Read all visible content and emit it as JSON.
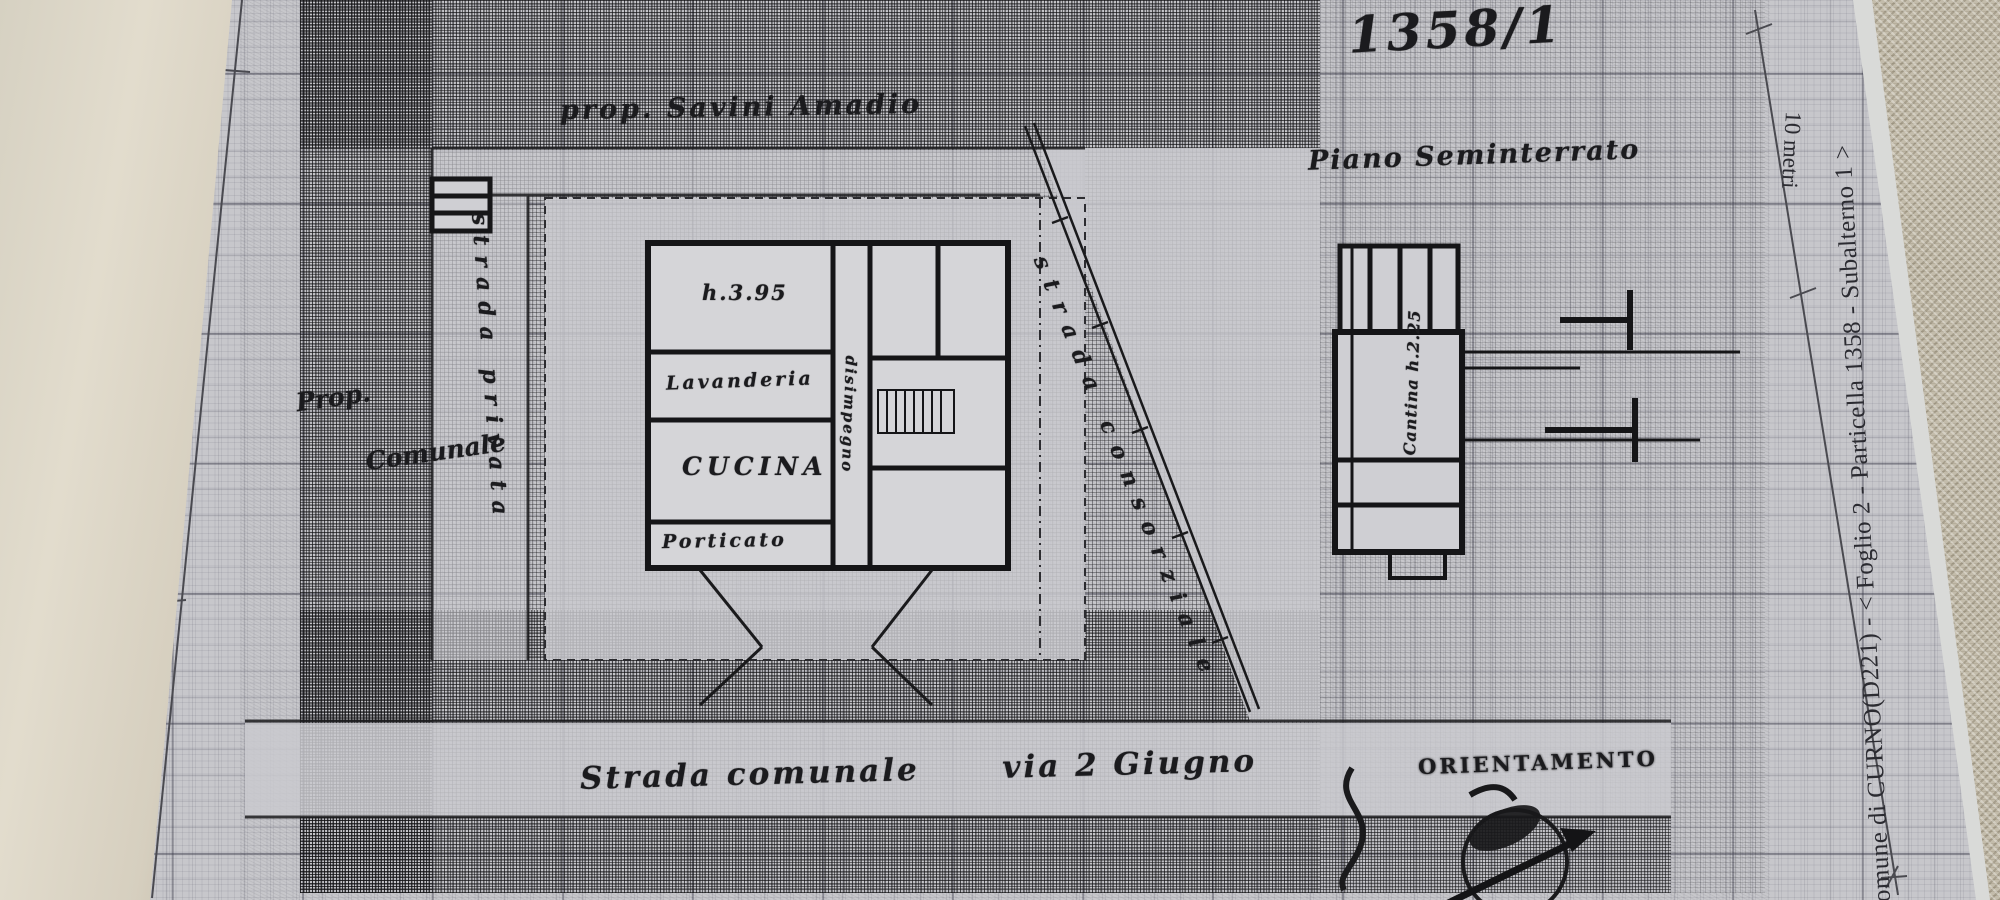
{
  "document": {
    "sheet_number": "1358/1",
    "caption_right": "Comune di CURNO(D221) - < Foglio 2 - Particella 1358 - Subalterno 1 >",
    "scale_label": "10 metri"
  },
  "map": {
    "owner_note": "prop. Savini Amadio",
    "basement_plan_title": "Piano Seminterrato",
    "street_main": "Strada comunale      via 2 Giugno",
    "road_diagonal_label": "strada consorziale",
    "road_left_label": "strada privata",
    "parcel_note_line1": "Prop.",
    "parcel_note_line2": "Comunale",
    "orientation_label": "ORIENTAMENTO",
    "rooms": {
      "kitchen": "CUCINA",
      "laundry": "Lavanderia",
      "hallway": "disimpegno",
      "porch": "Porticato",
      "height_note": "h.3.95",
      "cellar_note": "Cantina h.2.25"
    }
  },
  "colors": {
    "paper": "#c7c7cb",
    "ink": "#1b1b1e",
    "page_curl": "#ddd8ca",
    "fabric": "#c3bcab"
  }
}
